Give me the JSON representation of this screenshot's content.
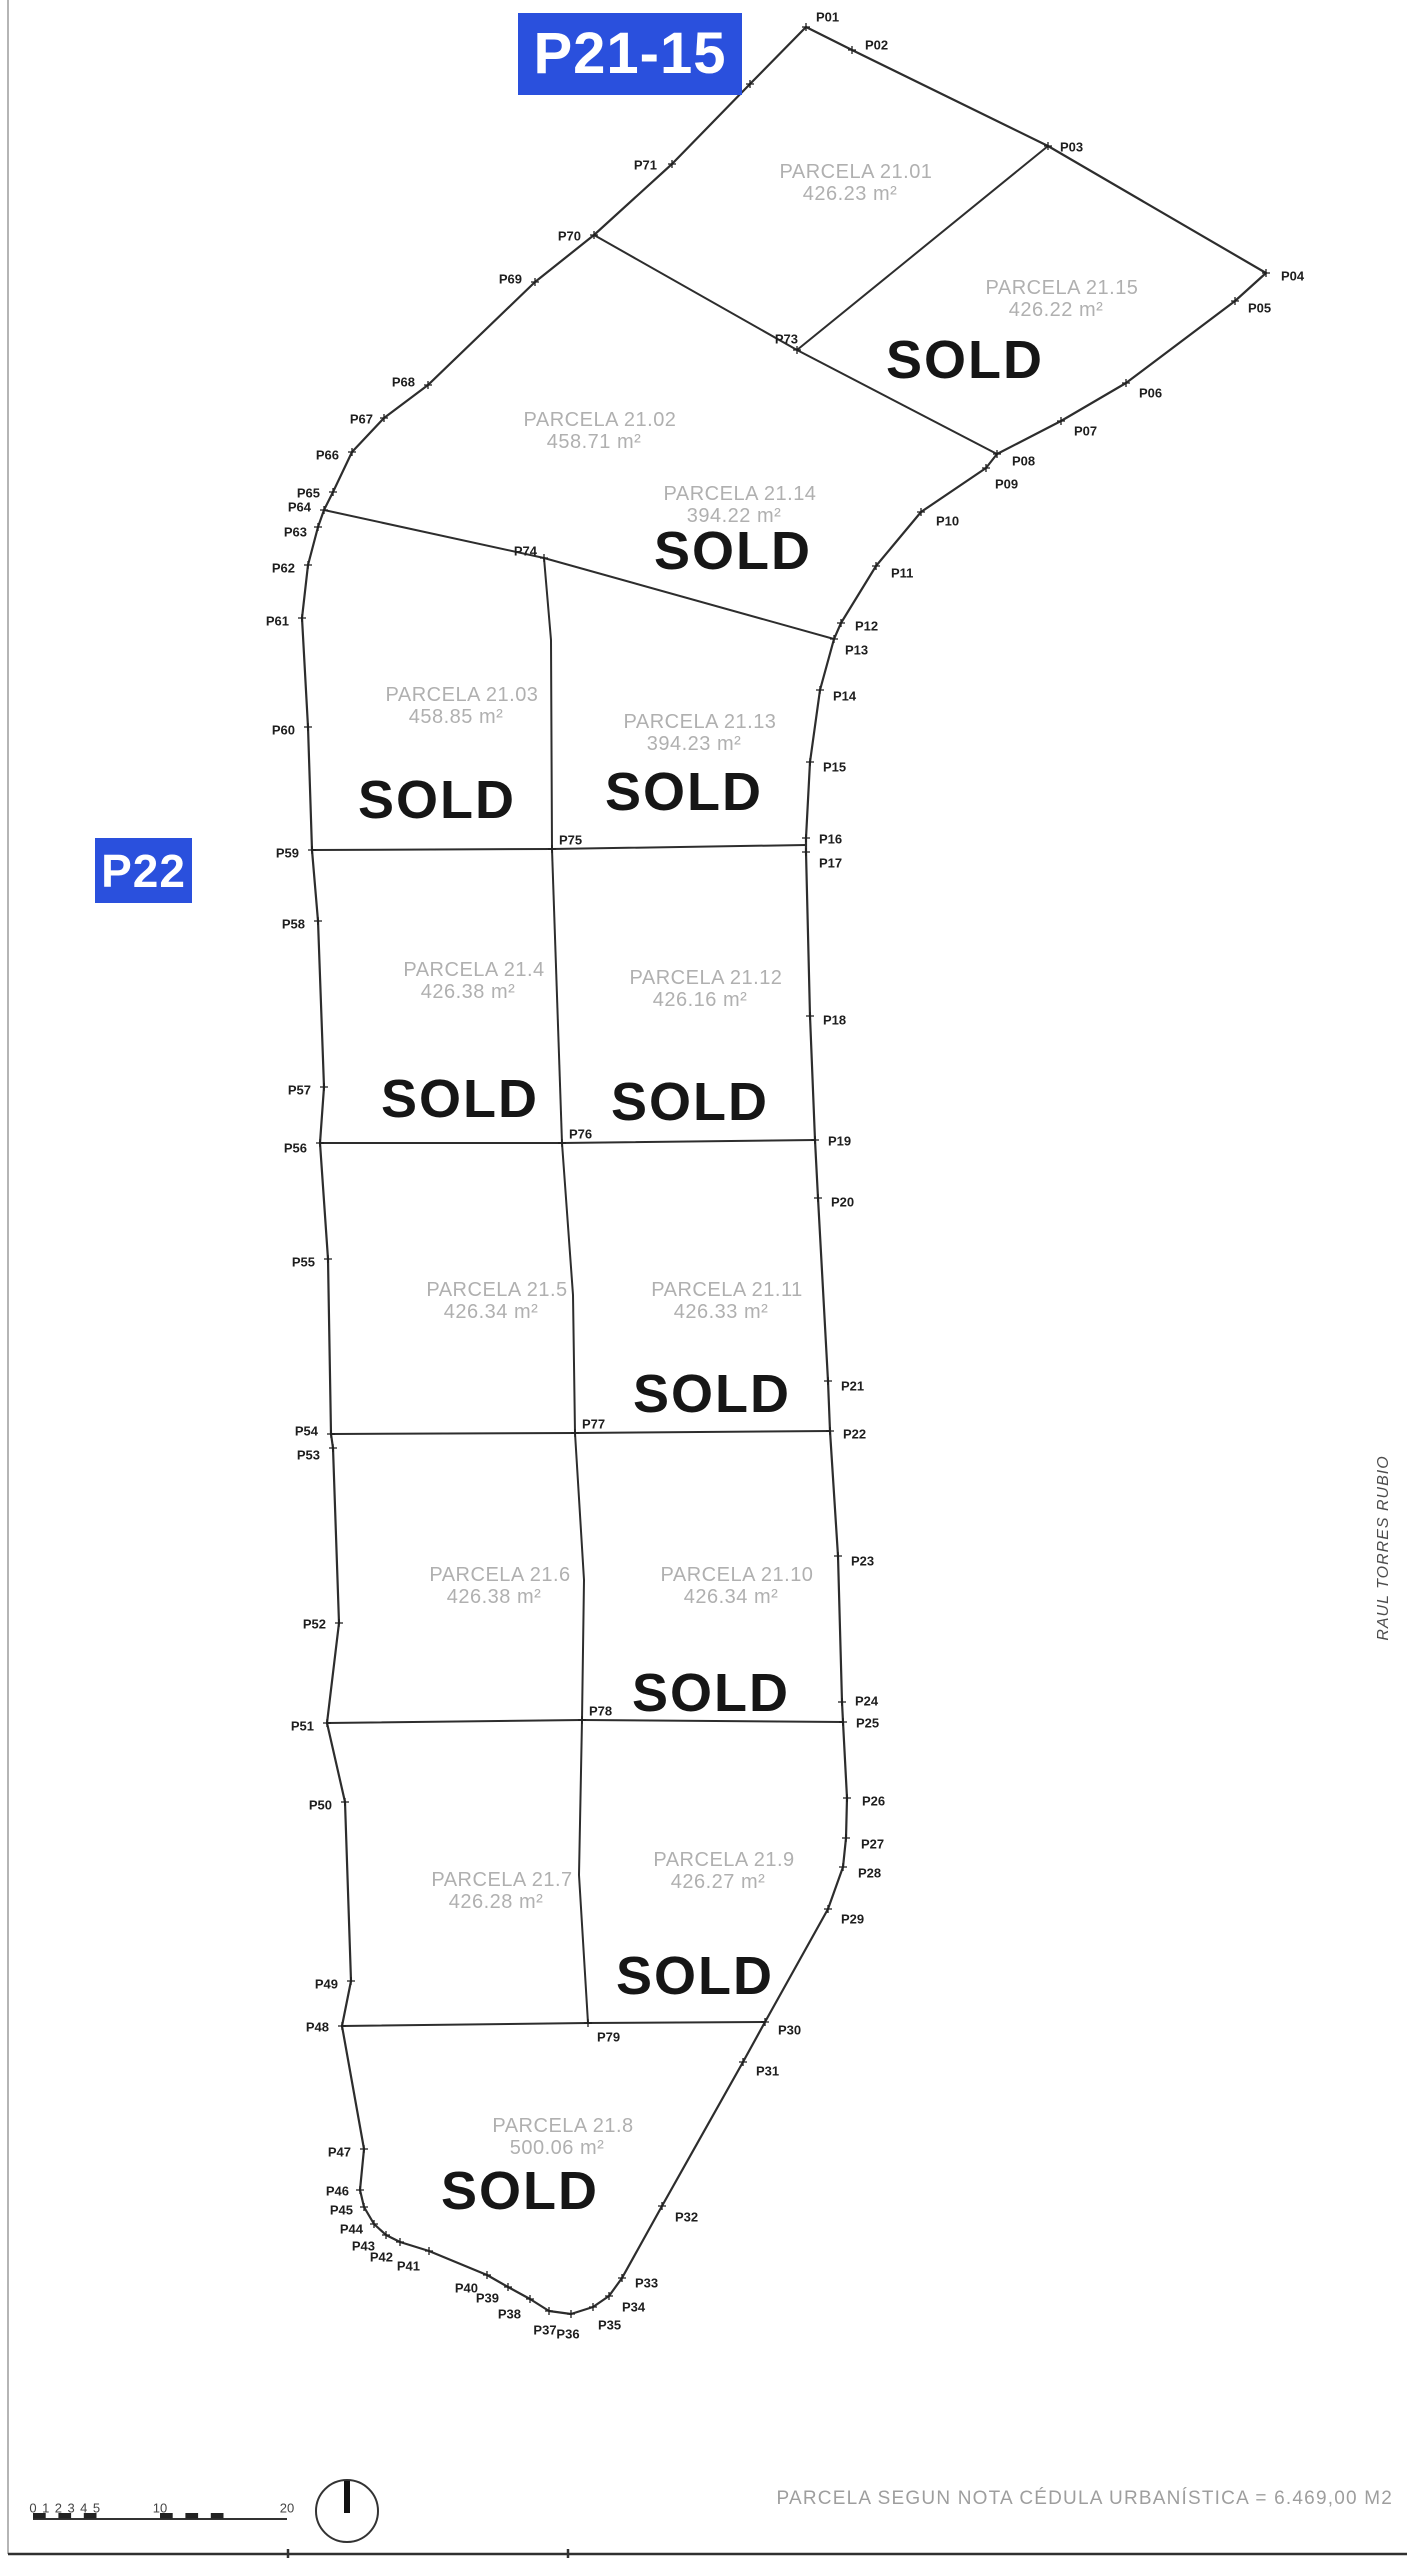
{
  "plan": {
    "badges": {
      "p21_15": {
        "text": "P21-15"
      },
      "p22": {
        "text": "P22"
      }
    },
    "colors": {
      "badge_bg": "#2a50dd",
      "boundary": "#2d2d2d",
      "divider": "#2d2d2d",
      "parcel_label": "#b0b0b0",
      "sold": "#161616",
      "point_label": "#1e1e1e",
      "scale_text": "#444444",
      "border_left": "#b5b5b5",
      "border_bottom": "#303030"
    },
    "points": [
      {
        "id": "P01",
        "x": 806,
        "y": 27,
        "dx": 10,
        "dy": -10,
        "anchor": "start"
      },
      {
        "id": "P02",
        "x": 852,
        "y": 50,
        "dx": 13,
        "dy": -5,
        "anchor": "start"
      },
      {
        "id": "P03",
        "x": 1048,
        "y": 146,
        "dx": 12,
        "dy": 1,
        "anchor": "start"
      },
      {
        "id": "P04",
        "x": 1266,
        "y": 273,
        "dx": 15,
        "dy": 3,
        "anchor": "start"
      },
      {
        "id": "P05",
        "x": 1235,
        "y": 301,
        "dx": 13,
        "dy": 7,
        "anchor": "start"
      },
      {
        "id": "P06",
        "x": 1126,
        "y": 383,
        "dx": 13,
        "dy": 10,
        "anchor": "start"
      },
      {
        "id": "P07",
        "x": 1061,
        "y": 421,
        "dx": 13,
        "dy": 10,
        "anchor": "start"
      },
      {
        "id": "P08",
        "x": 997,
        "y": 454,
        "dx": 15,
        "dy": 7,
        "anchor": "start"
      },
      {
        "id": "P09",
        "x": 986,
        "y": 468,
        "dx": 9,
        "dy": 16,
        "anchor": "start"
      },
      {
        "id": "P10",
        "x": 921,
        "y": 512,
        "dx": 15,
        "dy": 9,
        "anchor": "start"
      },
      {
        "id": "P11",
        "x": 876,
        "y": 566,
        "dx": 15,
        "dy": 7,
        "anchor": "start"
      },
      {
        "id": "P12",
        "x": 841,
        "y": 623,
        "dx": 14,
        "dy": 3,
        "anchor": "start"
      },
      {
        "id": "P13",
        "x": 834,
        "y": 639,
        "dx": 11,
        "dy": 11,
        "anchor": "start"
      },
      {
        "id": "P14",
        "x": 820,
        "y": 690,
        "dx": 13,
        "dy": 6,
        "anchor": "start"
      },
      {
        "id": "P15",
        "x": 810,
        "y": 762,
        "dx": 13,
        "dy": 5,
        "anchor": "start"
      },
      {
        "id": "P16",
        "x": 806,
        "y": 838,
        "dx": 13,
        "dy": 1,
        "anchor": "start"
      },
      {
        "id": "P17",
        "x": 806,
        "y": 852,
        "dx": 13,
        "dy": 11,
        "anchor": "start"
      },
      {
        "id": "P18",
        "x": 810,
        "y": 1016,
        "dx": 13,
        "dy": 4,
        "anchor": "start"
      },
      {
        "id": "P19",
        "x": 815,
        "y": 1140,
        "dx": 13,
        "dy": 1,
        "anchor": "start"
      },
      {
        "id": "P20",
        "x": 818,
        "y": 1198,
        "dx": 13,
        "dy": 4,
        "anchor": "start"
      },
      {
        "id": "P21",
        "x": 828,
        "y": 1381,
        "dx": 13,
        "dy": 5,
        "anchor": "start"
      },
      {
        "id": "P22",
        "x": 830,
        "y": 1431,
        "dx": 13,
        "dy": 3,
        "anchor": "start"
      },
      {
        "id": "P23",
        "x": 838,
        "y": 1556,
        "dx": 13,
        "dy": 5,
        "anchor": "start"
      },
      {
        "id": "P24",
        "x": 842,
        "y": 1702,
        "dx": 13,
        "dy": -1,
        "anchor": "start"
      },
      {
        "id": "P25",
        "x": 843,
        "y": 1722,
        "dx": 13,
        "dy": 1,
        "anchor": "start"
      },
      {
        "id": "P26",
        "x": 847,
        "y": 1798,
        "dx": 15,
        "dy": 3,
        "anchor": "start"
      },
      {
        "id": "P27",
        "x": 846,
        "y": 1838,
        "dx": 15,
        "dy": 6,
        "anchor": "start"
      },
      {
        "id": "P28",
        "x": 843,
        "y": 1867,
        "dx": 15,
        "dy": 6,
        "anchor": "start"
      },
      {
        "id": "P29",
        "x": 828,
        "y": 1909,
        "dx": 13,
        "dy": 10,
        "anchor": "start"
      },
      {
        "id": "P30",
        "x": 765,
        "y": 2022,
        "dx": 13,
        "dy": 8,
        "anchor": "start"
      },
      {
        "id": "P31",
        "x": 743,
        "y": 2062,
        "dx": 13,
        "dy": 9,
        "anchor": "start"
      },
      {
        "id": "P32",
        "x": 662,
        "y": 2206,
        "dx": 13,
        "dy": 11,
        "anchor": "start"
      },
      {
        "id": "P33",
        "x": 622,
        "y": 2278,
        "dx": 13,
        "dy": 5,
        "anchor": "start"
      },
      {
        "id": "P34",
        "x": 609,
        "y": 2296,
        "dx": 13,
        "dy": 11,
        "anchor": "start"
      },
      {
        "id": "P35",
        "x": 593,
        "y": 2307,
        "dx": 5,
        "dy": 18,
        "anchor": "start"
      },
      {
        "id": "P36",
        "x": 571,
        "y": 2314,
        "dx": -3,
        "dy": 20,
        "anchor": "middle"
      },
      {
        "id": "P37",
        "x": 549,
        "y": 2311,
        "dx": -4,
        "dy": 19,
        "anchor": "middle"
      },
      {
        "id": "P38",
        "x": 530,
        "y": 2299,
        "dx": -9,
        "dy": 15,
        "anchor": "end"
      },
      {
        "id": "P39",
        "x": 508,
        "y": 2287,
        "dx": -9,
        "dy": 11,
        "anchor": "end"
      },
      {
        "id": "P40",
        "x": 487,
        "y": 2275,
        "dx": -9,
        "dy": 13,
        "anchor": "end"
      },
      {
        "id": "P41",
        "x": 429,
        "y": 2251,
        "dx": -9,
        "dy": 15,
        "anchor": "end"
      },
      {
        "id": "P42",
        "x": 400,
        "y": 2242,
        "dx": -7,
        "dy": 15,
        "anchor": "end"
      },
      {
        "id": "P43",
        "x": 386,
        "y": 2235,
        "dx": -11,
        "dy": 11,
        "anchor": "end"
      },
      {
        "id": "P44",
        "x": 374,
        "y": 2224,
        "dx": -11,
        "dy": 5,
        "anchor": "end"
      },
      {
        "id": "P45",
        "x": 364,
        "y": 2207,
        "dx": -11,
        "dy": 3,
        "anchor": "end"
      },
      {
        "id": "P46",
        "x": 360,
        "y": 2190,
        "dx": -11,
        "dy": 1,
        "anchor": "end"
      },
      {
        "id": "P47",
        "x": 364,
        "y": 2149,
        "dx": -13,
        "dy": 3,
        "anchor": "end"
      },
      {
        "id": "P48",
        "x": 342,
        "y": 2026,
        "dx": -13,
        "dy": 1,
        "anchor": "end"
      },
      {
        "id": "P49",
        "x": 351,
        "y": 1981,
        "dx": -13,
        "dy": 3,
        "anchor": "end"
      },
      {
        "id": "P50",
        "x": 345,
        "y": 1802,
        "dx": -13,
        "dy": 3,
        "anchor": "end"
      },
      {
        "id": "P51",
        "x": 327,
        "y": 1723,
        "dx": -13,
        "dy": 3,
        "anchor": "end"
      },
      {
        "id": "P52",
        "x": 339,
        "y": 1623,
        "dx": -13,
        "dy": 1,
        "anchor": "end"
      },
      {
        "id": "P53",
        "x": 333,
        "y": 1448,
        "dx": -13,
        "dy": 7,
        "anchor": "end"
      },
      {
        "id": "P54",
        "x": 331,
        "y": 1434,
        "dx": -13,
        "dy": -3,
        "anchor": "end"
      },
      {
        "id": "P55",
        "x": 328,
        "y": 1259,
        "dx": -13,
        "dy": 3,
        "anchor": "end"
      },
      {
        "id": "P56",
        "x": 320,
        "y": 1143,
        "dx": -13,
        "dy": 5,
        "anchor": "end"
      },
      {
        "id": "P57",
        "x": 324,
        "y": 1087,
        "dx": -13,
        "dy": 3,
        "anchor": "end"
      },
      {
        "id": "P58",
        "x": 318,
        "y": 921,
        "dx": -13,
        "dy": 3,
        "anchor": "end"
      },
      {
        "id": "P59",
        "x": 312,
        "y": 850,
        "dx": -13,
        "dy": 3,
        "anchor": "end"
      },
      {
        "id": "P60",
        "x": 308,
        "y": 727,
        "dx": -13,
        "dy": 3,
        "anchor": "end"
      },
      {
        "id": "P61",
        "x": 302,
        "y": 618,
        "dx": -13,
        "dy": 3,
        "anchor": "end"
      },
      {
        "id": "P62",
        "x": 308,
        "y": 565,
        "dx": -13,
        "dy": 3,
        "anchor": "end"
      },
      {
        "id": "P63",
        "x": 318,
        "y": 527,
        "dx": -11,
        "dy": 5,
        "anchor": "end"
      },
      {
        "id": "P64",
        "x": 324,
        "y": 510,
        "dx": -13,
        "dy": -3,
        "anchor": "end"
      },
      {
        "id": "P65",
        "x": 333,
        "y": 492,
        "dx": -13,
        "dy": 1,
        "anchor": "end"
      },
      {
        "id": "P66",
        "x": 352,
        "y": 452,
        "dx": -13,
        "dy": 3,
        "anchor": "end"
      },
      {
        "id": "P67",
        "x": 384,
        "y": 418,
        "dx": -11,
        "dy": 1,
        "anchor": "end"
      },
      {
        "id": "P68",
        "x": 428,
        "y": 385,
        "dx": -13,
        "dy": -3,
        "anchor": "end"
      },
      {
        "id": "P69",
        "x": 535,
        "y": 282,
        "dx": -13,
        "dy": -3,
        "anchor": "end"
      },
      {
        "id": "P70",
        "x": 594,
        "y": 235,
        "dx": -13,
        "dy": 1,
        "anchor": "end"
      },
      {
        "id": "P71",
        "x": 672,
        "y": 164,
        "dx": -15,
        "dy": 1,
        "anchor": "end"
      },
      {
        "id": "P72",
        "x": 750,
        "y": 84,
        "dx": -15,
        "dy": 1,
        "anchor": "end"
      },
      {
        "id": "P73",
        "x": 797,
        "y": 350,
        "dx": 1,
        "dy": -11,
        "anchor": "end"
      },
      {
        "id": "P74",
        "x": 544,
        "y": 558,
        "dx": -7,
        "dy": -7,
        "anchor": "end"
      },
      {
        "id": "P75",
        "x": 552,
        "y": 849,
        "dx": 7,
        "dy": -9,
        "anchor": "start"
      },
      {
        "id": "P76",
        "x": 562,
        "y": 1143,
        "dx": 7,
        "dy": -9,
        "anchor": "start"
      },
      {
        "id": "P77",
        "x": 575,
        "y": 1433,
        "dx": 7,
        "dy": -9,
        "anchor": "start"
      },
      {
        "id": "P78",
        "x": 582,
        "y": 1720,
        "dx": 7,
        "dy": -9,
        "anchor": "start"
      },
      {
        "id": "P79",
        "x": 588,
        "y": 2023,
        "dx": 9,
        "dy": 14,
        "anchor": "start"
      }
    ],
    "outline": [
      "P01",
      "P02",
      "P03",
      "P04",
      "P05",
      "P06",
      "P07",
      "P08",
      "P09",
      "P10",
      "P11",
      "P12",
      "P13",
      "P14",
      "P15",
      "P16",
      "P17",
      "P18",
      "P19",
      "P20",
      "P21",
      "P22",
      "P23",
      "P24",
      "P25",
      "P26",
      "P27",
      "P28",
      "P29",
      "P30",
      "P31",
      "P32",
      "P33",
      "P34",
      "P35",
      "P36",
      "P37",
      "P38",
      "P39",
      "P40",
      "P41",
      "P42",
      "P43",
      "P44",
      "P45",
      "P46",
      "P47",
      "P48",
      "P49",
      "P50",
      "P51",
      "P52",
      "P53",
      "P54",
      "P55",
      "P56",
      "P57",
      "P58",
      "P59",
      "P60",
      "P61",
      "P62",
      "P63",
      "P64",
      "P65",
      "P66",
      "P67",
      "P68",
      "P69",
      "P70",
      "P71",
      "P72"
    ],
    "dividers": [
      [
        "P70",
        "P73"
      ],
      [
        "P03",
        "P73"
      ],
      [
        "P73",
        "P08"
      ],
      [
        "P64",
        "P74"
      ],
      [
        "P74",
        "P13"
      ],
      [
        "P74",
        [
          551,
          640
        ],
        "P75"
      ],
      [
        "P59",
        "P75",
        [
          806,
          845
        ]
      ],
      [
        "P56",
        "P76",
        "P19"
      ],
      [
        "P75",
        "P76"
      ],
      [
        "P54",
        "P77",
        "P22"
      ],
      [
        "P76",
        [
          573,
          1295
        ],
        "P77"
      ],
      [
        "P51",
        "P78",
        "P25"
      ],
      [
        "P77",
        [
          584,
          1580
        ],
        "P78"
      ],
      [
        "P48",
        "P79",
        "P30"
      ],
      [
        "P78",
        [
          579,
          1875
        ],
        "P79"
      ]
    ],
    "parcels": [
      {
        "name": "PARCELA 21.01",
        "area": "426.23 m²",
        "x": 856,
        "y": 172,
        "sold": null
      },
      {
        "name": "PARCELA 21.02",
        "area": "458.71 m²",
        "x": 600,
        "y": 420,
        "sold": null
      },
      {
        "name": "PARCELA 21.15",
        "area": "426.22 m²",
        "x": 1062,
        "y": 288,
        "sold": {
          "x": 965,
          "y": 360
        }
      },
      {
        "name": "PARCELA 21.14",
        "area": "394.22 m²",
        "x": 740,
        "y": 494,
        "sold": {
          "x": 733,
          "y": 551
        }
      },
      {
        "name": "PARCELA 21.03",
        "area": "458.85 m²",
        "x": 462,
        "y": 695,
        "sold": {
          "x": 437,
          "y": 800
        }
      },
      {
        "name": "PARCELA 21.13",
        "area": "394.23 m²",
        "x": 700,
        "y": 722,
        "sold": {
          "x": 684,
          "y": 792
        }
      },
      {
        "name": "PARCELA 21.4",
        "area": "426.38 m²",
        "x": 474,
        "y": 970,
        "sold": {
          "x": 460,
          "y": 1099
        }
      },
      {
        "name": "PARCELA 21.12",
        "area": "426.16 m²",
        "x": 706,
        "y": 978,
        "sold": {
          "x": 690,
          "y": 1102
        }
      },
      {
        "name": "PARCELA 21.5",
        "area": "426.34 m²",
        "x": 497,
        "y": 1290,
        "sold": null
      },
      {
        "name": "PARCELA 21.11",
        "area": "426.33 m²",
        "x": 727,
        "y": 1290,
        "sold": {
          "x": 712,
          "y": 1394
        }
      },
      {
        "name": "PARCELA 21.6",
        "area": "426.38 m²",
        "x": 500,
        "y": 1575,
        "sold": null
      },
      {
        "name": "PARCELA 21.10",
        "area": "426.34 m²",
        "x": 737,
        "y": 1575,
        "sold": {
          "x": 711,
          "y": 1693
        }
      },
      {
        "name": "PARCELA 21.7",
        "area": "426.28 m²",
        "x": 502,
        "y": 1880,
        "sold": null
      },
      {
        "name": "PARCELA 21.9",
        "area": "426.27 m²",
        "x": 724,
        "y": 1860,
        "sold": {
          "x": 695,
          "y": 1976
        }
      },
      {
        "name": "PARCELA 21.8",
        "area": "500.06 m²",
        "x": 563,
        "y": 2126,
        "sold": {
          "x": 520,
          "y": 2191
        }
      }
    ],
    "sold_text": "SOLD",
    "scale_bar": {
      "labels_small": [
        "0",
        "1",
        "2",
        "3",
        "4",
        "5"
      ],
      "label_mid": "10",
      "label_end": "20",
      "origin_x": 33,
      "unit_px": 12.7,
      "line_y": 2519,
      "label_y": 2508,
      "blocks": [
        [
          0,
          1
        ],
        [
          2,
          3
        ],
        [
          4,
          5
        ],
        [
          10,
          11
        ],
        [
          12,
          13
        ],
        [
          14,
          15
        ]
      ]
    },
    "north": {
      "cx": 347,
      "cy": 2511,
      "r": 31
    },
    "footer": {
      "note": "PARCELA SEGUN NOTA CÉDULA URBANÍSTICA = 6.469,00 M2",
      "author": "RAUL TORRES RUBIO"
    }
  }
}
